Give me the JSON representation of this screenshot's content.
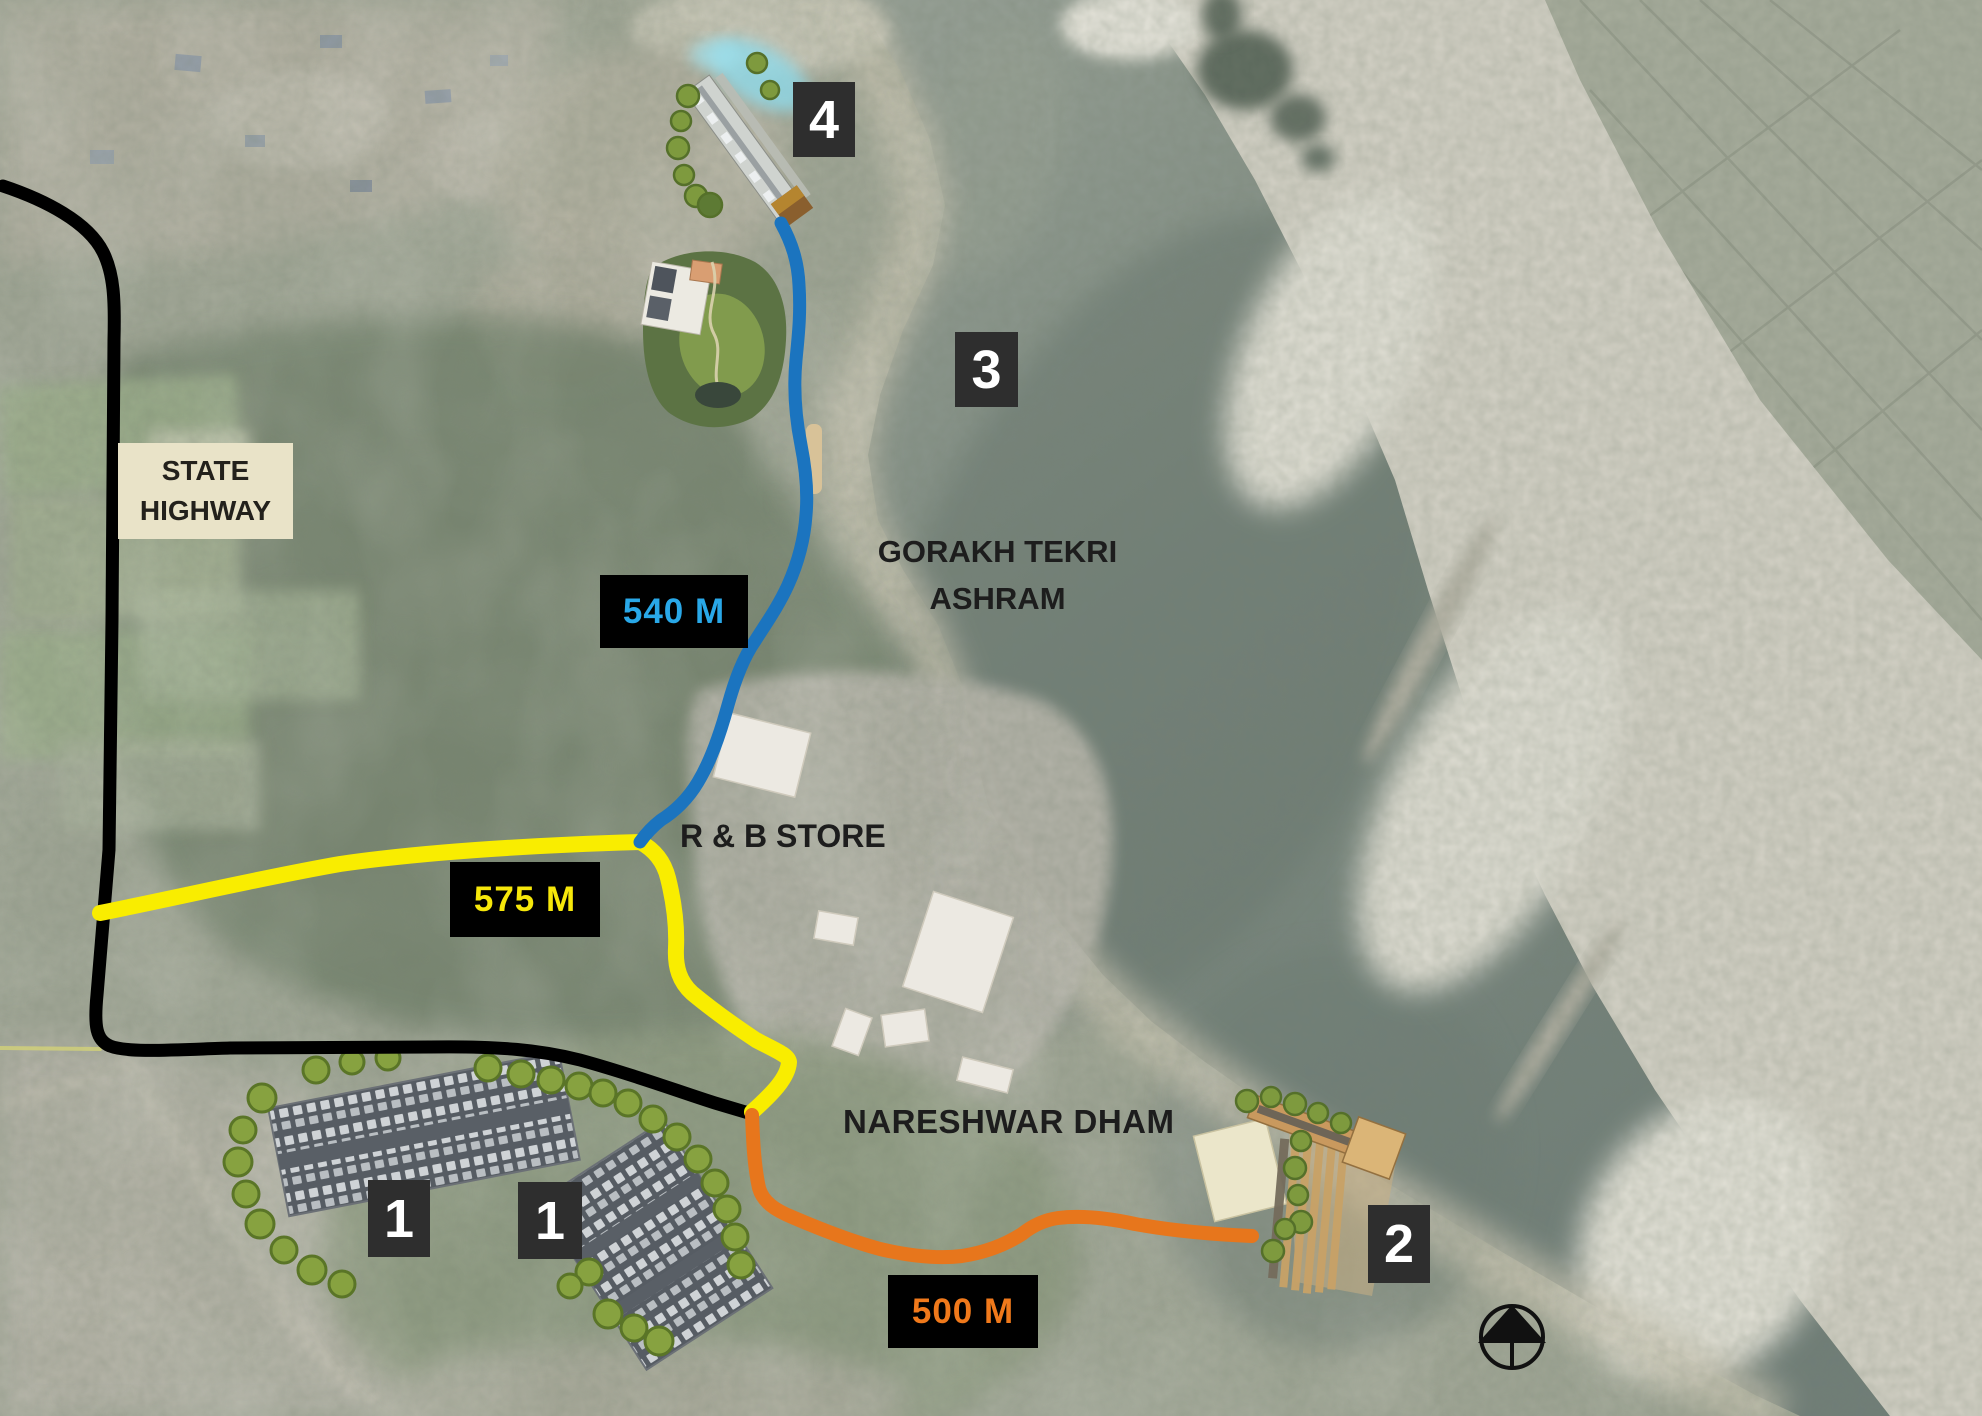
{
  "map": {
    "region_labels": {
      "state_highway_line1": "STATE",
      "state_highway_line2": "HIGHWAY",
      "gorakh_line1": "GORAKH TEKRI",
      "gorakh_line2": "ASHRAM",
      "rb_store": "R & B STORE",
      "nareshwar_dham": "NARESHWAR DHAM"
    },
    "markers": [
      {
        "label": "1"
      },
      {
        "label": "1"
      },
      {
        "label": "2"
      },
      {
        "label": "3"
      },
      {
        "label": "4"
      }
    ],
    "routes": {
      "state_highway": {
        "color": "#000000"
      },
      "blue": {
        "color": "#1b74bf",
        "distance": "540 M",
        "text_color": "#29a8e8"
      },
      "yellow": {
        "color": "#f9ed00",
        "distance": "575 M",
        "text_color": "#f6e70a"
      },
      "orange": {
        "color": "#e7761c",
        "distance": "500 M",
        "text_color": "#f0791b"
      }
    },
    "marker_style": {
      "bg": "#2e2e2e",
      "fg": "#ffffff"
    },
    "label_box_colors": {
      "distance_bg": "#000000",
      "highway_bg": "#e9e3c8"
    },
    "icons": {
      "north_arrow": "north-arrow"
    }
  }
}
